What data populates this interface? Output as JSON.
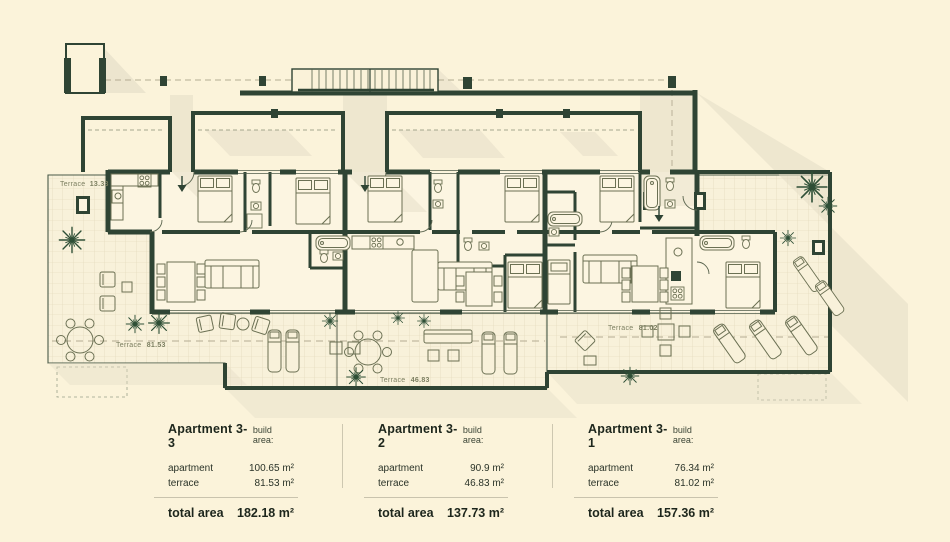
{
  "colors": {
    "background": "#fbf3da",
    "wall": "#2f4434",
    "furniture_line": "#6b7053",
    "shadow": "#e3dcc6",
    "terrace_label": "#7b7e60",
    "text": "#242e22"
  },
  "plan": {
    "terraces": [
      {
        "label": "Terrace",
        "area": "13.33"
      },
      {
        "label": "Terrace",
        "area": "81.53"
      },
      {
        "label": "Terrace",
        "area": "46.83"
      },
      {
        "label": "Terrace",
        "area": "81.02"
      }
    ]
  },
  "legend": {
    "apartments": [
      {
        "name": "Apartment 3-3",
        "build_area_label": "build area:",
        "rows": [
          {
            "label": "apartment",
            "value": "100.65 m²"
          },
          {
            "label": "terrace",
            "value": "81.53 m²"
          }
        ],
        "total": {
          "label": "total area",
          "value": "182.18 m²"
        }
      },
      {
        "name": "Apartment 3-2",
        "build_area_label": "build area:",
        "rows": [
          {
            "label": "apartment",
            "value": "90.9 m²"
          },
          {
            "label": "terrace",
            "value": "46.83 m²"
          }
        ],
        "total": {
          "label": "total area",
          "value": "137.73 m²"
        }
      },
      {
        "name": "Apartment 3-1",
        "build_area_label": "build area:",
        "rows": [
          {
            "label": "apartment",
            "value": "76.34 m²"
          },
          {
            "label": "terrace",
            "value": "81.02 m²"
          }
        ],
        "total": {
          "label": "total area",
          "value": "157.36 m²"
        }
      }
    ]
  }
}
